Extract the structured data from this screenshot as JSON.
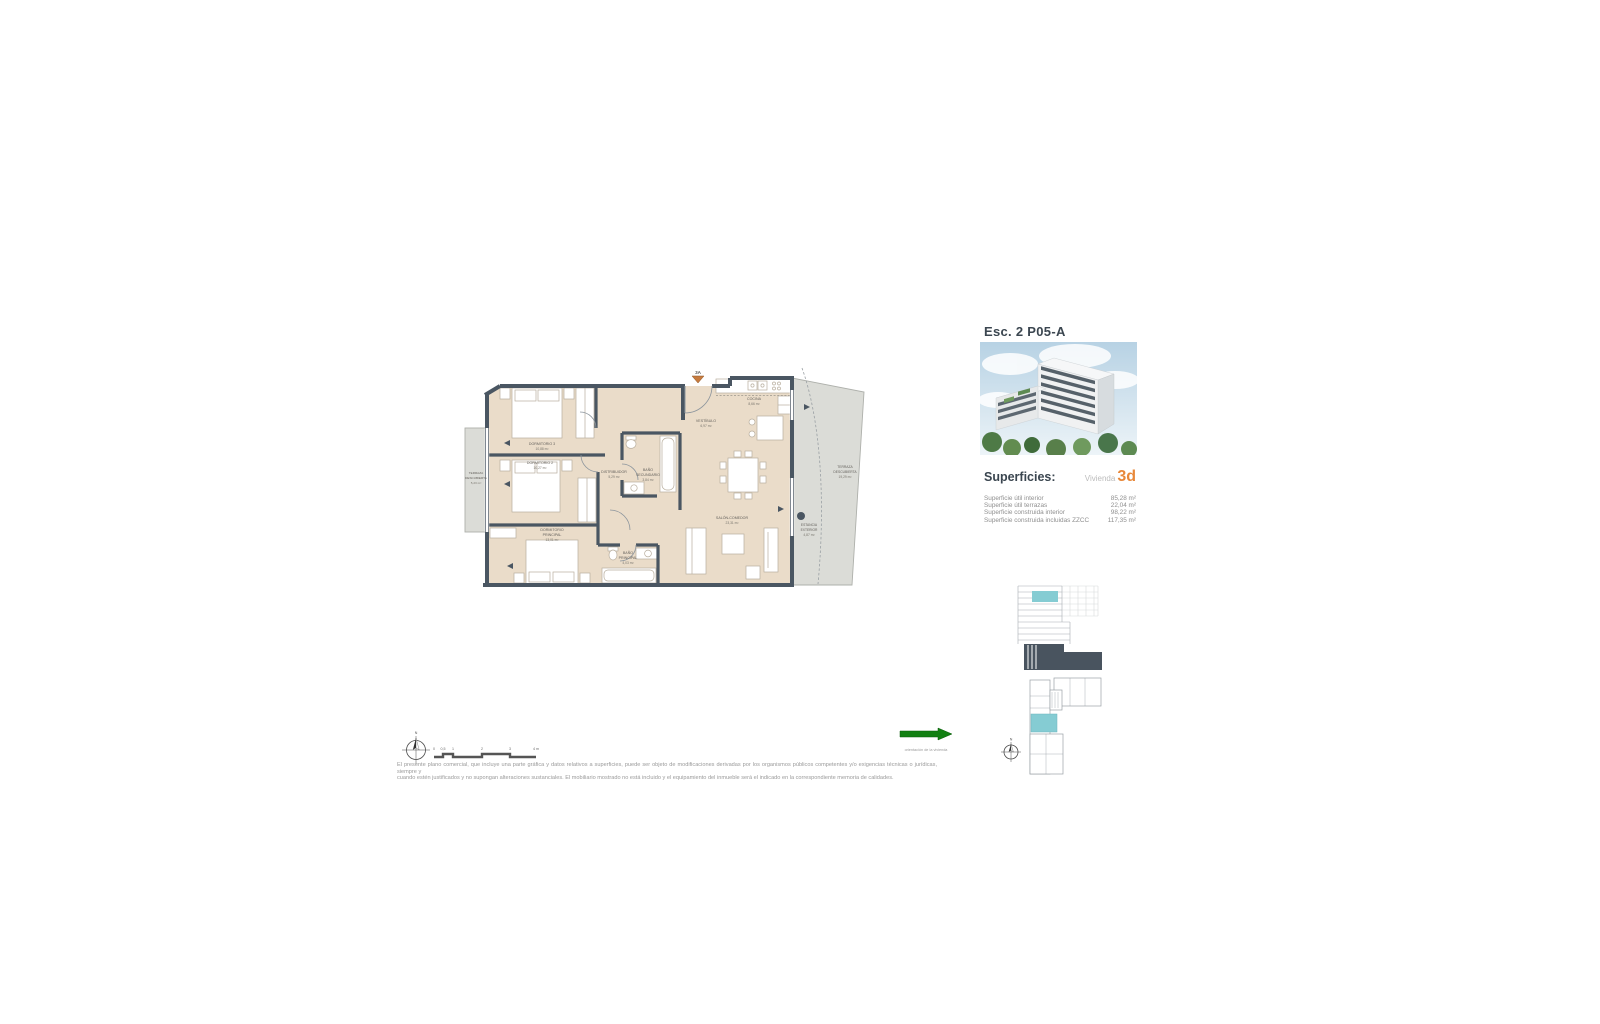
{
  "header": {
    "title": "Esc. 2 P05-A"
  },
  "superficies": {
    "heading": "Superficies:",
    "unit_label": "Vivienda",
    "unit_code": "3d",
    "rows": [
      {
        "label": "Superficie útil interior",
        "value": "85,28 m²"
      },
      {
        "label": "Superficie útil terrazas",
        "value": "22,04 m²"
      },
      {
        "label": "Superficie construida interior",
        "value": "98,22 m²"
      },
      {
        "label": "Superficie construida incluidas ZZCC",
        "value": "117,35 m²"
      }
    ]
  },
  "plan": {
    "entrance_label": "3A",
    "rooms": {
      "dormitorio3": {
        "name": "DORMITORIO 3",
        "area": "10,88 m²"
      },
      "dormitorio2": {
        "name": "DORMITORIO 2",
        "area": "10,27 m²"
      },
      "dormitorio_principal": {
        "line1": "DORMITORIO",
        "line2": "PRINCIPAL",
        "area": "13,01 m²"
      },
      "bano_principal": {
        "line1": "BAÑO",
        "line2": "PRINCIPAL",
        "area": "4,03 m²"
      },
      "bano_secundario": {
        "line1": "BAÑO",
        "line2": "SECUNDARIO",
        "area": "3,84 m²"
      },
      "distribuidor": {
        "name": "DISTRIBUIDOR",
        "area": "5,29 m²"
      },
      "vestibulo": {
        "name": "VESTÍBULO",
        "area": "6,97 m²"
      },
      "cocina": {
        "name": "COCINA",
        "area": "8,66 m²"
      },
      "salon_comedor": {
        "name": "SALÓN-COMEDOR",
        "area": "23,31 m²"
      },
      "terraza_izquierda": {
        "line1": "TERRAZA",
        "line2": "DESCUBIERTA",
        "area": "5,23 m²"
      },
      "terraza_derecha": {
        "line1": "TERRAZA",
        "line2": "DESCUBIERTA",
        "area": "19,29 m²"
      },
      "estancia_exterior": {
        "line1": "ESTANCIA",
        "line2": "EXTERIOR",
        "area": "4,87 m²"
      }
    }
  },
  "compass": {
    "north": "N"
  },
  "scale_bar": {
    "ticks": [
      "0",
      "0,5",
      "1",
      "2",
      "3",
      "4 m"
    ]
  },
  "legend": {
    "arrow_caption": "orientación de la vivienda"
  },
  "disclaimer": {
    "line1": "El presente plano comercial, que incluye una parte gráfica y datos relativos a superficies, puede ser objeto de modificaciones derivadas por los organismos públicos competentes y/o exigencias técnicas o jurídicas, siempre y",
    "line2": "cuando estén justificados y no supongan alteraciones sustanciales. El mobiliario mostrado no está incluido y el equipamiento del inmueble será el indicado en la correspondiente memoria de calidades."
  },
  "colors": {
    "wall": "#4a5662",
    "floor": "#eadcc9",
    "terrace": "#dbdcd7",
    "accent_orange": "#e8883a",
    "highlight_teal": "#85ccd3",
    "arrow_green": "#128012"
  }
}
